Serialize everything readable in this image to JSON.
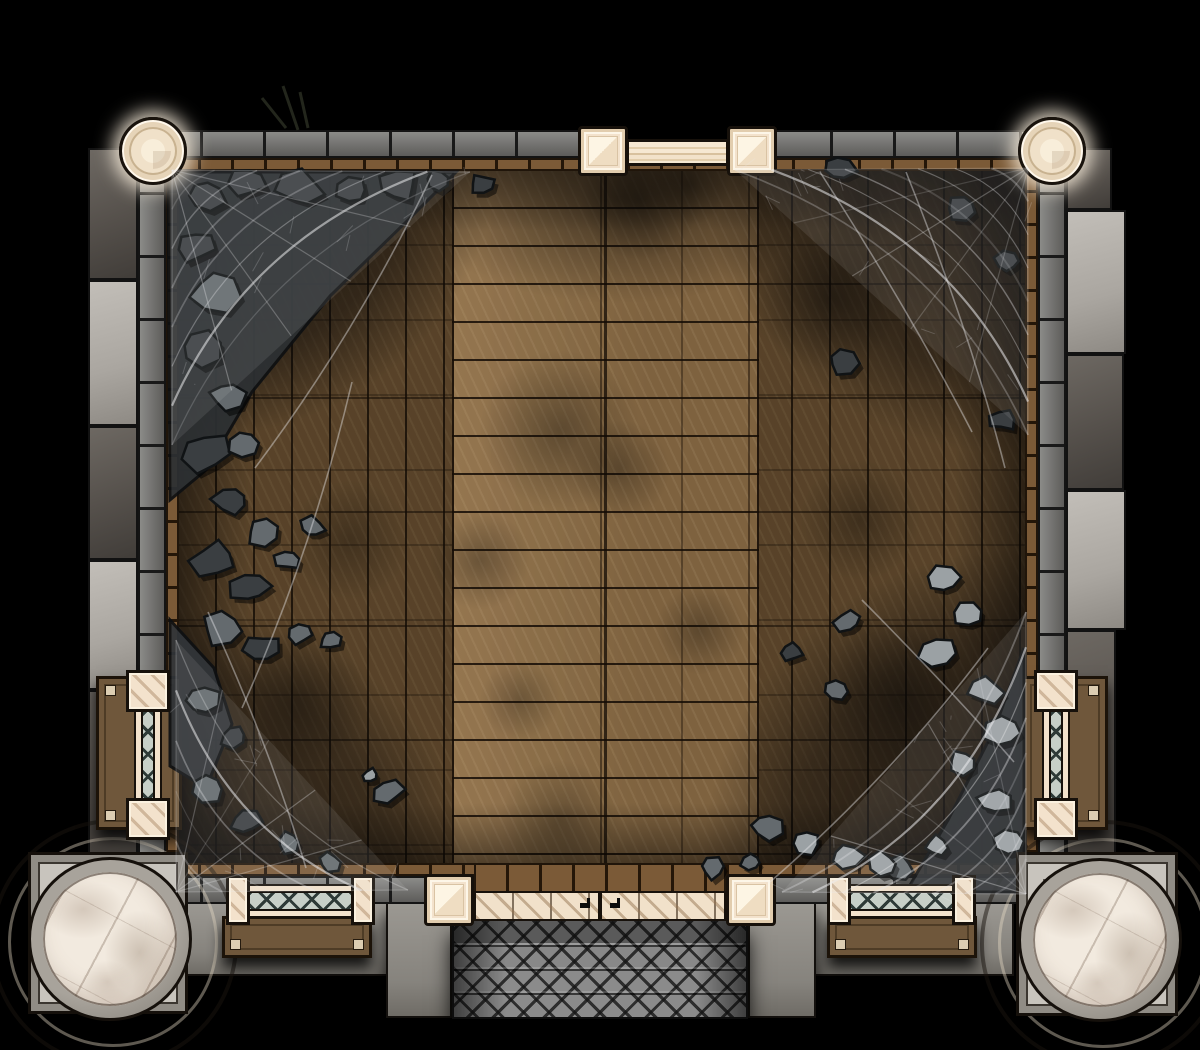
{
  "map": {
    "kind": "dungeon-room-battle-map",
    "width": 1200,
    "height": 1050
  },
  "colors": {
    "bg": "#000000",
    "wall-hi": "#8b8b88",
    "wall-lo": "#5d5c5a",
    "trim": "#7b5a37",
    "floor-aisle": "#8c6d46",
    "floor-flank": "#6b5233",
    "cream": "#f3e2cc",
    "marble": "#f2eadf",
    "lattice-bg": "#c7cfc7",
    "lattice-line": "#2e3a37",
    "bench": "#6f573b",
    "step": "#8b8b8b",
    "rock-dark": "#3a3e41",
    "rock-mid": "#646a6e",
    "rock-light": "#9ba1a4",
    "web": "#ececee"
  },
  "scene": {
    "buttresses": [
      {
        "x": 88,
        "y": 148,
        "w": 50,
        "h": 132,
        "t": "d"
      },
      {
        "x": 88,
        "y": 280,
        "w": 50,
        "h": 146,
        "t": "l"
      },
      {
        "x": 88,
        "y": 426,
        "w": 50,
        "h": 134,
        "t": "d"
      },
      {
        "x": 88,
        "y": 560,
        "w": 50,
        "h": 130,
        "t": "l"
      },
      {
        "x": 88,
        "y": 690,
        "w": 50,
        "h": 166,
        "t": "d"
      },
      {
        "x": 1066,
        "y": 148,
        "w": 46,
        "h": 62,
        "t": "d"
      },
      {
        "x": 1066,
        "y": 210,
        "w": 60,
        "h": 144,
        "t": "l"
      },
      {
        "x": 1066,
        "y": 354,
        "w": 58,
        "h": 136,
        "t": "d"
      },
      {
        "x": 1066,
        "y": 490,
        "w": 60,
        "h": 140,
        "t": "l"
      },
      {
        "x": 1066,
        "y": 630,
        "w": 50,
        "h": 226,
        "t": "d"
      }
    ],
    "slabs": [
      {
        "x": 186,
        "y": 902,
        "w": 266,
        "h": 74
      },
      {
        "x": 386,
        "y": 902,
        "w": 66,
        "h": 116
      },
      {
        "x": 748,
        "y": 902,
        "w": 266,
        "h": 74
      },
      {
        "x": 748,
        "y": 902,
        "w": 68,
        "h": 116
      }
    ],
    "blobs": [
      {
        "x": 640,
        "y": 200,
        "r": 60,
        "a": 0.45
      },
      {
        "x": 690,
        "y": 185,
        "r": 40,
        "a": 0.4
      },
      {
        "x": 560,
        "y": 430,
        "r": 80,
        "a": 0.35
      },
      {
        "x": 620,
        "y": 470,
        "r": 50,
        "a": 0.3
      },
      {
        "x": 700,
        "y": 630,
        "r": 45,
        "a": 0.3
      },
      {
        "x": 520,
        "y": 700,
        "r": 40,
        "a": 0.25
      },
      {
        "x": 830,
        "y": 300,
        "r": 70,
        "a": 0.4
      },
      {
        "x": 860,
        "y": 520,
        "r": 60,
        "a": 0.35
      },
      {
        "x": 900,
        "y": 700,
        "r": 80,
        "a": 0.45
      },
      {
        "x": 480,
        "y": 560,
        "r": 50,
        "a": 0.3
      },
      {
        "x": 350,
        "y": 540,
        "r": 60,
        "a": 0.3
      },
      {
        "x": 300,
        "y": 700,
        "r": 70,
        "a": 0.35
      },
      {
        "x": 560,
        "y": 820,
        "r": 60,
        "a": 0.3
      },
      {
        "x": 860,
        "y": 200,
        "r": 50,
        "a": 0.35
      }
    ],
    "piles": [
      {
        "points": "168,172 456,172 404,224 330,296 252,392 206,470 170,500",
        "fill": "#2c3033"
      },
      {
        "points": "1024,648 1024,892 906,892 948,820 994,730",
        "fill": "#2b2e31"
      },
      {
        "points": "170,620 214,668 232,724 206,788 170,766",
        "fill": "#313539"
      }
    ],
    "rocks": [
      {
        "x": 205,
        "y": 195,
        "s": 26,
        "t": 0,
        "r": 0.4
      },
      {
        "x": 248,
        "y": 182,
        "s": 20,
        "t": 0,
        "r": 1.2
      },
      {
        "x": 300,
        "y": 188,
        "s": 24,
        "t": 0,
        "r": 2.1
      },
      {
        "x": 352,
        "y": 190,
        "s": 18,
        "t": 0,
        "r": 0.9
      },
      {
        "x": 398,
        "y": 186,
        "s": 22,
        "t": 0,
        "r": 2.8
      },
      {
        "x": 438,
        "y": 180,
        "s": 14,
        "t": 0,
        "r": 1.5
      },
      {
        "x": 196,
        "y": 246,
        "s": 22,
        "t": 0,
        "r": 0.2
      },
      {
        "x": 214,
        "y": 292,
        "s": 26,
        "t": 1,
        "r": 1.1
      },
      {
        "x": 200,
        "y": 348,
        "s": 24,
        "t": 0,
        "r": 2.4
      },
      {
        "x": 226,
        "y": 396,
        "s": 20,
        "t": 1,
        "r": 0.7
      },
      {
        "x": 206,
        "y": 452,
        "s": 26,
        "t": 0,
        "r": 1.9
      },
      {
        "x": 244,
        "y": 444,
        "s": 16,
        "t": 1,
        "r": 2.6
      },
      {
        "x": 232,
        "y": 500,
        "s": 22,
        "t": 0,
        "r": 0.5
      },
      {
        "x": 262,
        "y": 532,
        "s": 18,
        "t": 1,
        "r": 1.4
      },
      {
        "x": 214,
        "y": 560,
        "s": 24,
        "t": 0,
        "r": 2.2
      },
      {
        "x": 250,
        "y": 588,
        "s": 20,
        "t": 0,
        "r": 0.8
      },
      {
        "x": 288,
        "y": 560,
        "s": 14,
        "t": 1,
        "r": 1.7
      },
      {
        "x": 222,
        "y": 628,
        "s": 22,
        "t": 1,
        "r": 2.9
      },
      {
        "x": 262,
        "y": 648,
        "s": 18,
        "t": 0,
        "r": 0.3
      },
      {
        "x": 300,
        "y": 634,
        "s": 14,
        "t": 1,
        "r": 1.0
      },
      {
        "x": 312,
        "y": 528,
        "s": 14,
        "t": 1,
        "r": 2.0
      },
      {
        "x": 330,
        "y": 640,
        "s": 12,
        "t": 1,
        "r": 0.6
      },
      {
        "x": 202,
        "y": 700,
        "s": 18,
        "t": 1,
        "r": 1.3
      },
      {
        "x": 234,
        "y": 736,
        "s": 16,
        "t": 0,
        "r": 2.5
      },
      {
        "x": 208,
        "y": 788,
        "s": 18,
        "t": 1,
        "r": 0.1
      },
      {
        "x": 246,
        "y": 822,
        "s": 16,
        "t": 0,
        "r": 1.8
      },
      {
        "x": 288,
        "y": 842,
        "s": 14,
        "t": 1,
        "r": 2.7
      },
      {
        "x": 330,
        "y": 862,
        "s": 12,
        "t": 1,
        "r": 0.9
      },
      {
        "x": 388,
        "y": 792,
        "s": 16,
        "t": 1,
        "r": 1.6
      },
      {
        "x": 370,
        "y": 776,
        "s": 10,
        "t": 2,
        "r": 2.3
      },
      {
        "x": 482,
        "y": 184,
        "s": 14,
        "t": 0,
        "r": 0.5
      },
      {
        "x": 838,
        "y": 168,
        "s": 18,
        "t": 0,
        "r": 1.1
      },
      {
        "x": 962,
        "y": 208,
        "s": 16,
        "t": 0,
        "r": 2.2
      },
      {
        "x": 1008,
        "y": 262,
        "s": 14,
        "t": 0,
        "r": 0.8
      },
      {
        "x": 842,
        "y": 362,
        "s": 16,
        "t": 0,
        "r": 1.9
      },
      {
        "x": 1002,
        "y": 420,
        "s": 14,
        "t": 0,
        "r": 2.6
      },
      {
        "x": 848,
        "y": 622,
        "s": 14,
        "t": 1,
        "r": 0.4
      },
      {
        "x": 792,
        "y": 652,
        "s": 12,
        "t": 0,
        "r": 1.2
      },
      {
        "x": 836,
        "y": 690,
        "s": 12,
        "t": 1,
        "r": 2.0
      },
      {
        "x": 944,
        "y": 580,
        "s": 18,
        "t": 2,
        "r": 0.7
      },
      {
        "x": 968,
        "y": 614,
        "s": 16,
        "t": 2,
        "r": 1.5
      },
      {
        "x": 938,
        "y": 652,
        "s": 20,
        "t": 2,
        "r": 2.8
      },
      {
        "x": 986,
        "y": 690,
        "s": 18,
        "t": 2,
        "r": 0.2
      },
      {
        "x": 1004,
        "y": 732,
        "s": 20,
        "t": 2,
        "r": 1.0
      },
      {
        "x": 962,
        "y": 762,
        "s": 16,
        "t": 2,
        "r": 2.4
      },
      {
        "x": 994,
        "y": 800,
        "s": 18,
        "t": 2,
        "r": 0.6
      },
      {
        "x": 1010,
        "y": 842,
        "s": 16,
        "t": 2,
        "r": 1.7
      },
      {
        "x": 936,
        "y": 846,
        "s": 14,
        "t": 2,
        "r": 2.9
      },
      {
        "x": 900,
        "y": 868,
        "s": 16,
        "t": 1,
        "r": 0.3
      },
      {
        "x": 766,
        "y": 826,
        "s": 18,
        "t": 1,
        "r": 1.4
      },
      {
        "x": 806,
        "y": 842,
        "s": 20,
        "t": 2,
        "r": 2.1
      },
      {
        "x": 846,
        "y": 856,
        "s": 18,
        "t": 2,
        "r": 0.9
      },
      {
        "x": 884,
        "y": 864,
        "s": 16,
        "t": 2,
        "r": 1.8
      },
      {
        "x": 712,
        "y": 868,
        "s": 14,
        "t": 1,
        "r": 2.5
      },
      {
        "x": 752,
        "y": 862,
        "s": 12,
        "t": 1,
        "r": 0.1
      }
    ],
    "twigs": [
      {
        "x1": 283,
        "y1": 86,
        "x2": 298,
        "y2": 130
      },
      {
        "x1": 300,
        "y1": 92,
        "x2": 308,
        "y2": 128
      },
      {
        "x1": 262,
        "y1": 98,
        "x2": 286,
        "y2": 128
      }
    ],
    "webs": [
      {
        "name": "cobweb-top-left",
        "cx": 172,
        "cy": 170,
        "ax": 470,
        "ay": 172,
        "bx": 172,
        "by": 445,
        "layers": 7,
        "seed": 11
      },
      {
        "name": "cobweb-top-right",
        "cx": 1028,
        "cy": 168,
        "ax": 735,
        "ay": 170,
        "bx": 1028,
        "by": 435,
        "layers": 8,
        "seed": 23
      },
      {
        "name": "cobweb-bottom-right",
        "cx": 1026,
        "cy": 894,
        "ax": 782,
        "ay": 892,
        "bx": 1026,
        "by": 612,
        "layers": 8,
        "seed": 37
      },
      {
        "name": "cobweb-bottom-left",
        "cx": 176,
        "cy": 892,
        "ax": 408,
        "ay": 890,
        "bx": 176,
        "by": 640,
        "layers": 5,
        "seed": 49
      }
    ],
    "strands": [
      [
        432,
        175,
        255,
        468
      ],
      [
        352,
        382,
        242,
        708
      ],
      [
        208,
        612,
        306,
        868
      ],
      [
        972,
        432,
        820,
        172
      ],
      [
        1005,
        468,
        906,
        172
      ],
      [
        1014,
        762,
        862,
        600
      ],
      [
        988,
        648,
        770,
        882
      ]
    ]
  }
}
